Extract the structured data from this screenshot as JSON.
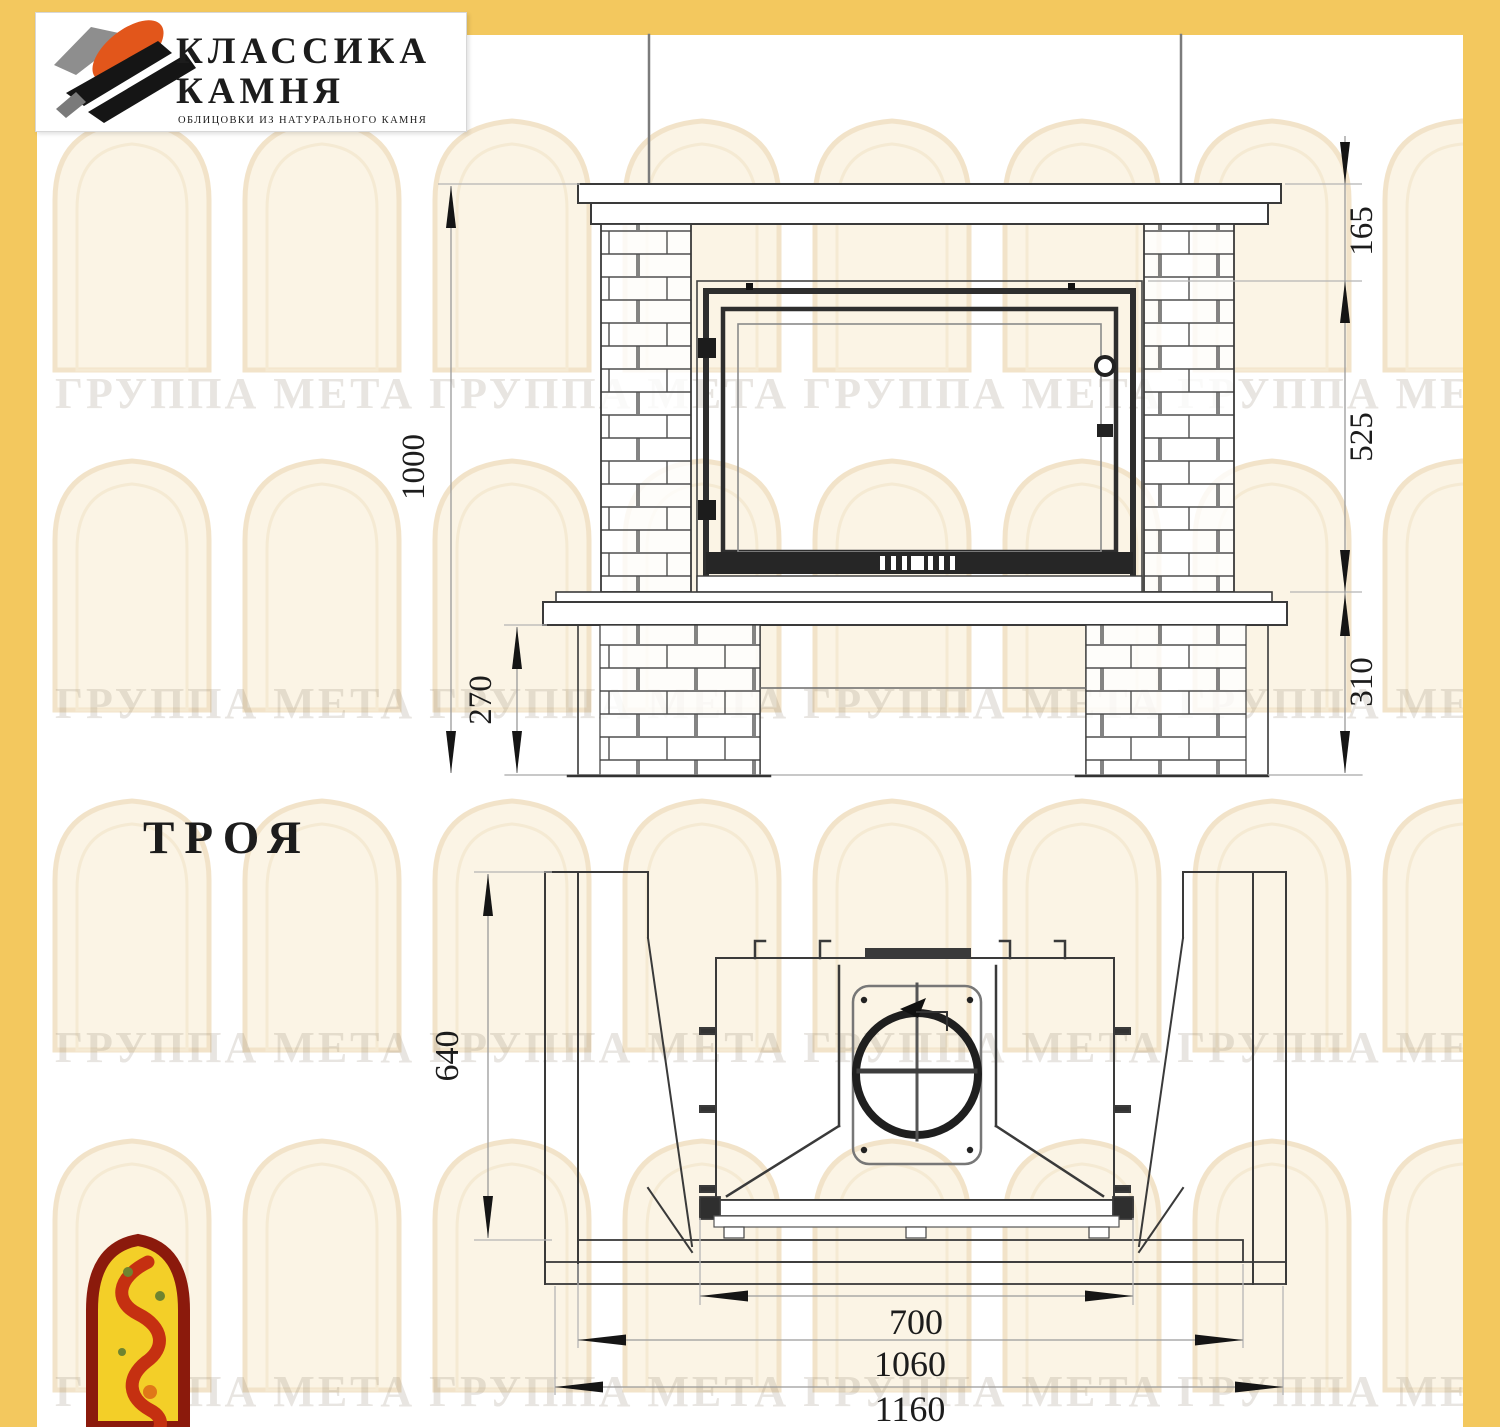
{
  "logo": {
    "line1": "КЛАССИКА",
    "line2": "КАМНЯ",
    "tagline": "ОБЛИЦОВКИ ИЗ НАТУРАЛЬНОГО КАМНЯ"
  },
  "model": {
    "name": "ТРОЯ"
  },
  "watermark": {
    "row": "ГРУППА МЕТА ГРУППА МЕТА ГРУППА МЕТА ГРУППА МЕТА"
  },
  "front_view": {
    "dims": {
      "total_height": "1000",
      "mantel_band": "165",
      "firebox_height": "525",
      "base_height": "310",
      "plinth_height": "270"
    }
  },
  "plan_view": {
    "dims": {
      "depth": "640",
      "firebox_width": "700",
      "portal_width": "1060",
      "total_width": "1160"
    }
  },
  "colors": {
    "accent_yellow": "#f3c85e",
    "emblem_red": "#8b1a0c",
    "emblem_yellow": "#f3cf28",
    "logo_orange": "#e2561b"
  }
}
